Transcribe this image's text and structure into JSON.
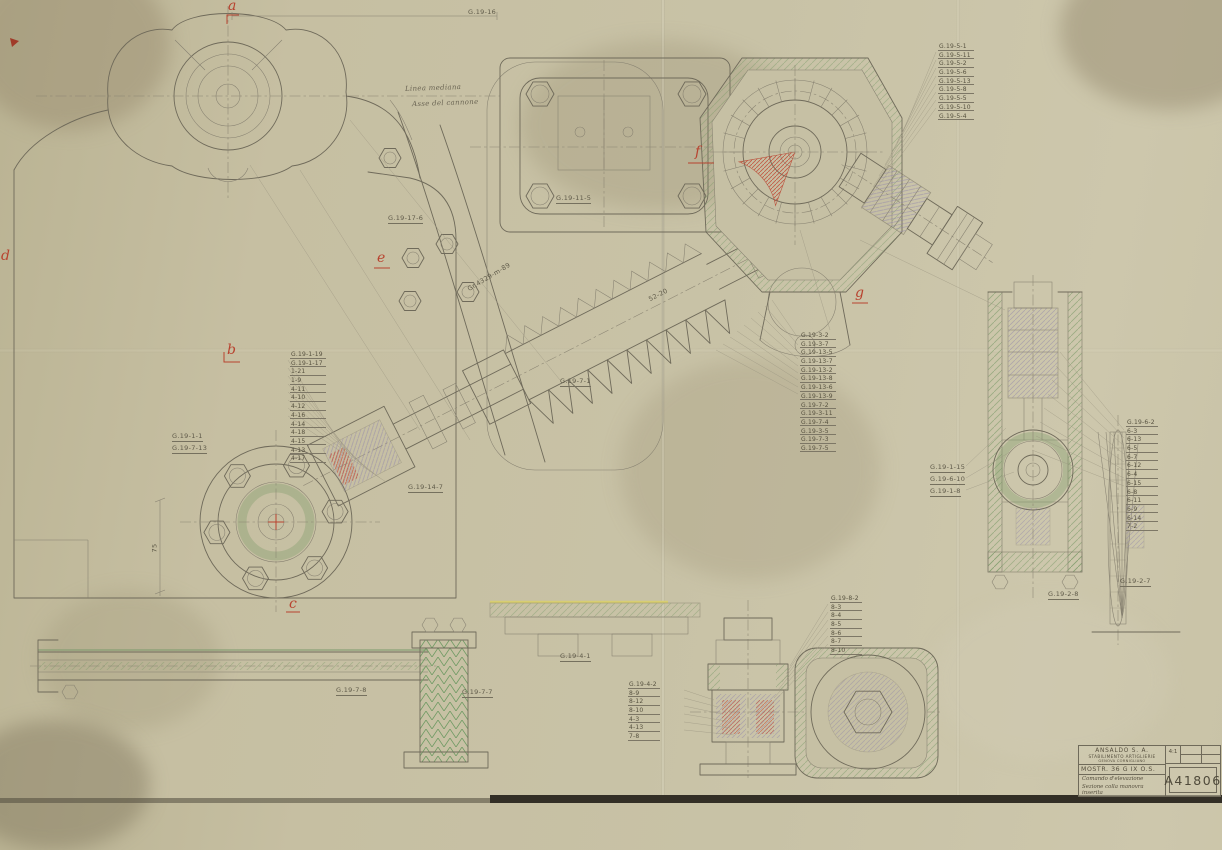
{
  "document": {
    "type": "technical-drawing",
    "drawing_number": "A41806"
  },
  "red_labels": {
    "a": "a",
    "b": "b",
    "c": "c",
    "d": "d",
    "e": "e",
    "f": "f",
    "g": "g"
  },
  "annotations": {
    "linea_mediana": "Linea mediana",
    "asse_cannone": "Asse del cannone",
    "top_dim": "G.19-16",
    "gr_note": "Gr.4329-m-89",
    "dim_52": "52-20",
    "dim_75": "75",
    "g19_17_6": "G.19-17-6",
    "g19_11_5": "G.19-11-5",
    "g19_7_1": "G.19-7-1",
    "g19_14_7": "G.19-14-7",
    "g19_1_1": "G.19-1-1",
    "g19_7_13": "G.19-7-13",
    "g19_7_8": "G.19-7-8",
    "g19_7_7": "G.19-7-7",
    "g19_4_1": "G.19-4-1",
    "g19_1_15": "G.19-1-15",
    "g19_6_10": "G.19-6-10",
    "g19_1_8": "G.19-1-8",
    "g19_2_8": "G.19-2-8",
    "g19_2_7": "G.19-2-7"
  },
  "callouts": {
    "top_right": {
      "items": [
        "G.19-5-1",
        "G.19-5-11",
        "G.19-5-2",
        "G.19-5-6",
        "G.19-5-13",
        "G.19-5-8",
        "G.19-5-5",
        "G.19-5-10",
        "G.19-5-4"
      ]
    },
    "left": {
      "items": [
        "G.19-1-19",
        "G.19-1-17",
        "1-21",
        "1-9",
        "4-11",
        "4-10",
        "4-12",
        "4-16",
        "4-14",
        "4-18",
        "4-15",
        "4-13",
        "4-17"
      ]
    },
    "center": {
      "items": [
        "G.19-3-2",
        "G.19-3-7",
        "G.19-13-5",
        "G.19-13-7",
        "G.19-13-2",
        "G.19-13-8",
        "G.19-13-6",
        "G.19-13-9",
        "G.19-7-2",
        "G.19-3-11",
        "G.19-7-4",
        "G.19-3-5",
        "G.19-7-3",
        "G.19-7-5"
      ]
    },
    "right": {
      "items": [
        "G.19-6-2",
        "6-3",
        "6-13",
        "6-5",
        "6-7",
        "6-12",
        "6-4",
        "6-15",
        "6-8",
        "6-11",
        "6-9",
        "6-14",
        "7-2"
      ]
    },
    "bottom_right": {
      "items": [
        "G.19-8-2",
        "8-3",
        "8-4",
        "8-5",
        "8-6",
        "8-7",
        "8-10"
      ]
    },
    "bottom_left": {
      "items": [
        "G.19-4-2",
        "8-9",
        "8-12",
        "8-10",
        "4-3",
        "4-13",
        "7-8"
      ]
    }
  },
  "title_block": {
    "company": "ANSALDO S. A.",
    "division": "STABILIMENTO ARTIGLIERIE",
    "location": "GENOVA CORNIGLIANO",
    "drawing_ref": "MOSTR. 36 G IX O.S.",
    "subject_line1": "Comando d'elevazione",
    "subject_line2": "Sezione colla manovra inserita",
    "scale": "4:1",
    "drawing_number": "A41806"
  },
  "colors": {
    "paper": "#c6bfa2",
    "pencil": "#6f6a5a",
    "section_green": "#79996a",
    "highlight_red": "#b8432f",
    "tint_purple": "#8b7fad",
    "tint_yellow": "#d8ce72"
  }
}
